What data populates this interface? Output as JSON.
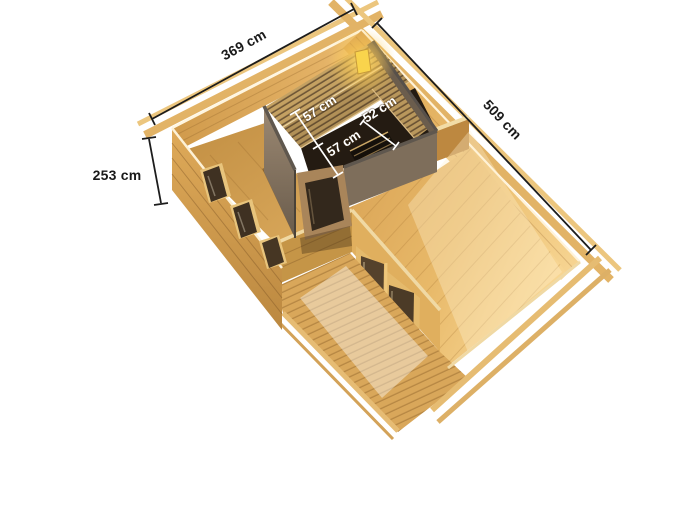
{
  "illustration": {
    "subject": "garden-sauna-cabin-top-view",
    "dimensions": {
      "front_width_label": "369 cm",
      "side_length_label": "509 cm",
      "wall_height_label": "253 cm",
      "sauna_bench_back_depth_label": "57 cm",
      "sauna_bench_right_width_label": "52 cm",
      "sauna_bench_front_depth_label": "57 cm"
    },
    "colors": {
      "background": "#ffffff",
      "dimension_line": "#1c1c1c",
      "dimension_text": "#1a1a1a",
      "sauna_dimension_text": "#ffffff",
      "wood_beam": "#eac47b",
      "wood_wall_warm": "#dca858",
      "wood_floor_bright": "#f6cf8a",
      "wood_deck": "#d9a75a",
      "sauna_wall_taupe": "#8d7b66",
      "glass_dark": "#3f3122",
      "lamp_glow": "#ffd84a"
    }
  }
}
